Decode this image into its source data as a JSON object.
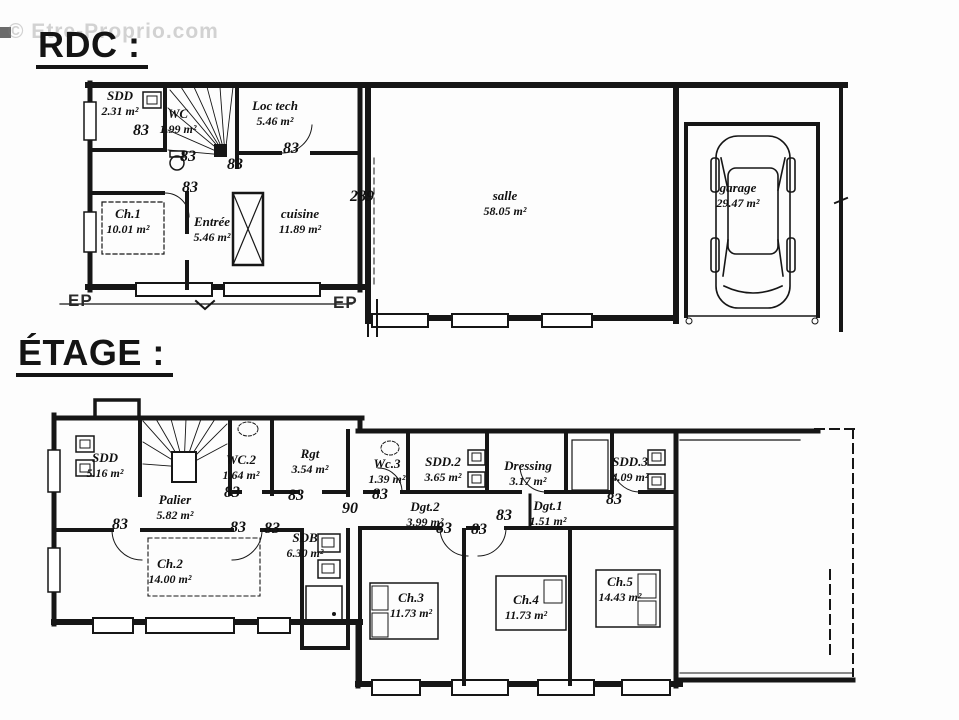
{
  "watermark": "© Etre-Proprio.com",
  "floors": [
    {
      "title": "RDC :",
      "rooms": [
        {
          "name": "SDD",
          "area": "2.31 m²"
        },
        {
          "name": "WC",
          "area": "1.99 m²"
        },
        {
          "name": "Loc tech",
          "area": "5.46 m²"
        },
        {
          "name": "Ch.1",
          "area": "10.01 m²"
        },
        {
          "name": "Entrée",
          "area": "5.46 m²"
        },
        {
          "name": "cuisine",
          "area": "11.89 m²"
        },
        {
          "name": "salle",
          "area": "58.05 m²"
        },
        {
          "name": "garage",
          "area": "29.47 m²"
        }
      ],
      "dims": [
        "83",
        "83",
        "83",
        "83",
        "83",
        "289"
      ],
      "annotations": [
        "EP",
        "EP"
      ]
    },
    {
      "title": "ÉTAGE :",
      "rooms": [
        {
          "name": "SDD",
          "area": "5.16 m²"
        },
        {
          "name": "Palier",
          "area": "5.82 m²"
        },
        {
          "name": "WC.2",
          "area": "1.64 m²"
        },
        {
          "name": "Rgt",
          "area": "3.54 m²"
        },
        {
          "name": "Wc.3",
          "area": "1.39 m²"
        },
        {
          "name": "SDD.2",
          "area": "3.65 m²"
        },
        {
          "name": "Dressing",
          "area": "3.17 m²"
        },
        {
          "name": "SDD.3",
          "area": "4.09 m²"
        },
        {
          "name": "Dgt.2",
          "area": "3.99 m²"
        },
        {
          "name": "Dgt.1",
          "area": "1.51 m²"
        },
        {
          "name": "SDB",
          "area": "6.30 m²"
        },
        {
          "name": "Ch.2",
          "area": "14.00 m²"
        },
        {
          "name": "Ch.3",
          "area": "11.73 m²"
        },
        {
          "name": "Ch.4",
          "area": "11.73 m²"
        },
        {
          "name": "Ch.5",
          "area": "14.43 m²"
        }
      ],
      "dims": [
        "90",
        "83",
        "83",
        "83",
        "83",
        "83",
        "83",
        "83",
        "83",
        "83",
        "83"
      ]
    }
  ]
}
